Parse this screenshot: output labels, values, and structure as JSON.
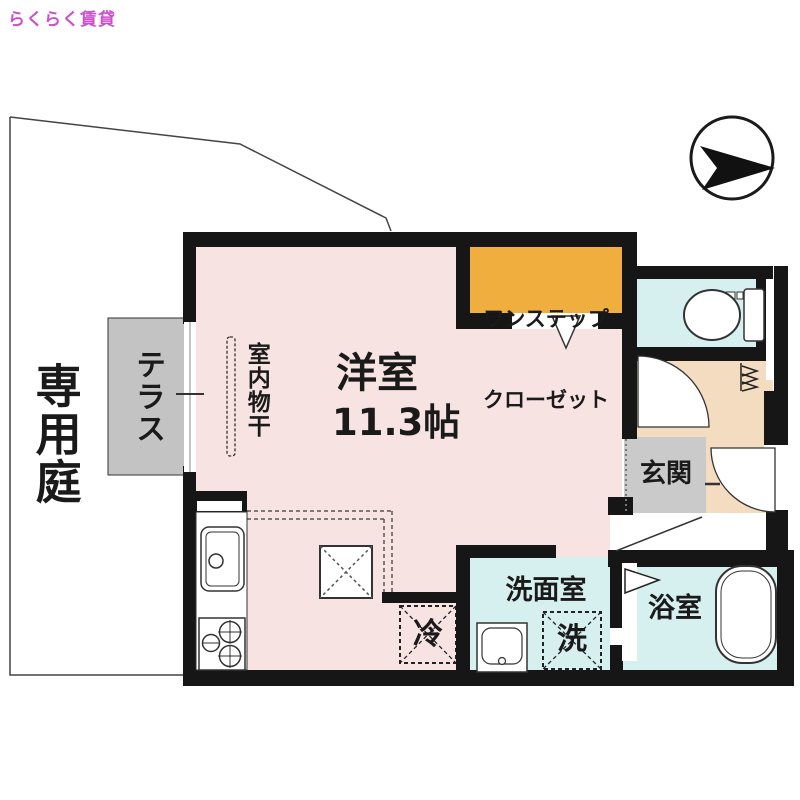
{
  "site": {
    "logo_text": "らくらく賃貸"
  },
  "floorplan": {
    "garden": {
      "label": "専用庭"
    },
    "terrace": {
      "label": "テラス"
    },
    "drying": {
      "label": "室内物干"
    },
    "room": {
      "label": "洋室",
      "size": "11.3帖"
    },
    "closet": {
      "line1": "ワンステップ",
      "line2": "クローゼット"
    },
    "entrance": {
      "label": "玄関"
    },
    "washroom": {
      "label": "洗面室"
    },
    "washer": {
      "label": "洗"
    },
    "fridge": {
      "label": "冷"
    },
    "bathroom": {
      "label": "浴室"
    },
    "icons": {
      "compass": "north-arrow-icon",
      "toilet": "toilet-icon",
      "bathtub": "bathtub-icon",
      "kitchen_sink": "kitchen-sink-icon",
      "stove": "stove-burners-icon",
      "vanity": "wash-basin-icon",
      "doors": [
        "door-swing-icon",
        "entrance-door-swing-icon",
        "folding-door-icon",
        "closet-entry-arrow-icon"
      ],
      "window": "sliding-window-icon",
      "shoe_shelf": "shoe-shelf-icon"
    },
    "colors": {
      "room_pink": "#f8e3e3",
      "terrace_gray": "#c4c3c3",
      "entrance_hall_gray": "#cbcaca",
      "closet_orange": "#f0ae3e",
      "wet_area_cyan": "#d6efef",
      "entry_beige": "#f4dcc1",
      "wall_black": "#161616",
      "logo_magenta": "#cc4fcc",
      "boundary_line": "#444444"
    }
  }
}
